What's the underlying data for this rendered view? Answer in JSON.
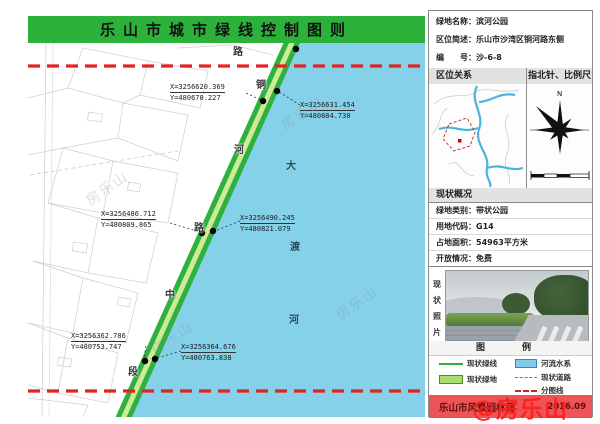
{
  "header": {
    "title": "乐山市城市绿线控制图则"
  },
  "info": {
    "name_label": "绿地名称：",
    "name_value": "滨河公园",
    "location_label": "区位简述：",
    "location_value": "乐山市沙湾区铜河路东侧",
    "number_label": "编　　号：",
    "number_value": "沙-6-8"
  },
  "panels": {
    "location_header": "区位关系",
    "compass_header": "指北针、比例尺",
    "north_letter": "N",
    "status_header": "现状概况",
    "status_rows": [
      {
        "label": "绿地类别：",
        "value": "带状公园"
      },
      {
        "label": "用地代码：",
        "value": "G14"
      },
      {
        "label": "占地面积：",
        "value": "54963平方米"
      },
      {
        "label": "开放情况：",
        "value": "免费"
      }
    ],
    "photo_label_chars": [
      "现",
      "状",
      "照",
      "片"
    ],
    "legend_header": "图　例",
    "legend_items": [
      {
        "label": "现状绿线",
        "color": "#2fae3c"
      },
      {
        "label": "现状绿地",
        "color": "#a8dd6e"
      },
      {
        "label": "河流水系",
        "color": "#7fcdea"
      },
      {
        "label": "现状道路",
        "color": "#777777"
      },
      {
        "label": "分图线",
        "color": "#d42222"
      }
    ],
    "footer_agency": "乐山市风景园林局",
    "footer_date": "2016.09",
    "watermark_red": "@房乐山",
    "watermark_faint": "房乐山"
  },
  "map": {
    "coordinate_points": [
      {
        "x_text": "X=3256620.369",
        "y_text": "Y=480670.227"
      },
      {
        "x_text": "X=3256631.454",
        "y_text": "Y=480884.730"
      },
      {
        "x_text": "X=3256486.712",
        "y_text": "Y=480809.865"
      },
      {
        "x_text": "X=3256490.245",
        "y_text": "Y=480821.079"
      },
      {
        "x_text": "X=3256362.786",
        "y_text": "Y=480753.747"
      },
      {
        "x_text": "X=3256364.676",
        "y_text": "Y=480763.838"
      }
    ],
    "road_chars": [
      "路",
      "铜",
      "河",
      "路",
      "中",
      "段"
    ],
    "river_chars": [
      "大",
      "渡",
      "河"
    ]
  },
  "colors": {
    "banner_green": "#2cb23b",
    "green_line": "#2fb13f",
    "green_inner": "#cdea96",
    "river_blue": "#86d1ea",
    "red_dash": "#e32222",
    "footer_red": "#ee5355"
  }
}
